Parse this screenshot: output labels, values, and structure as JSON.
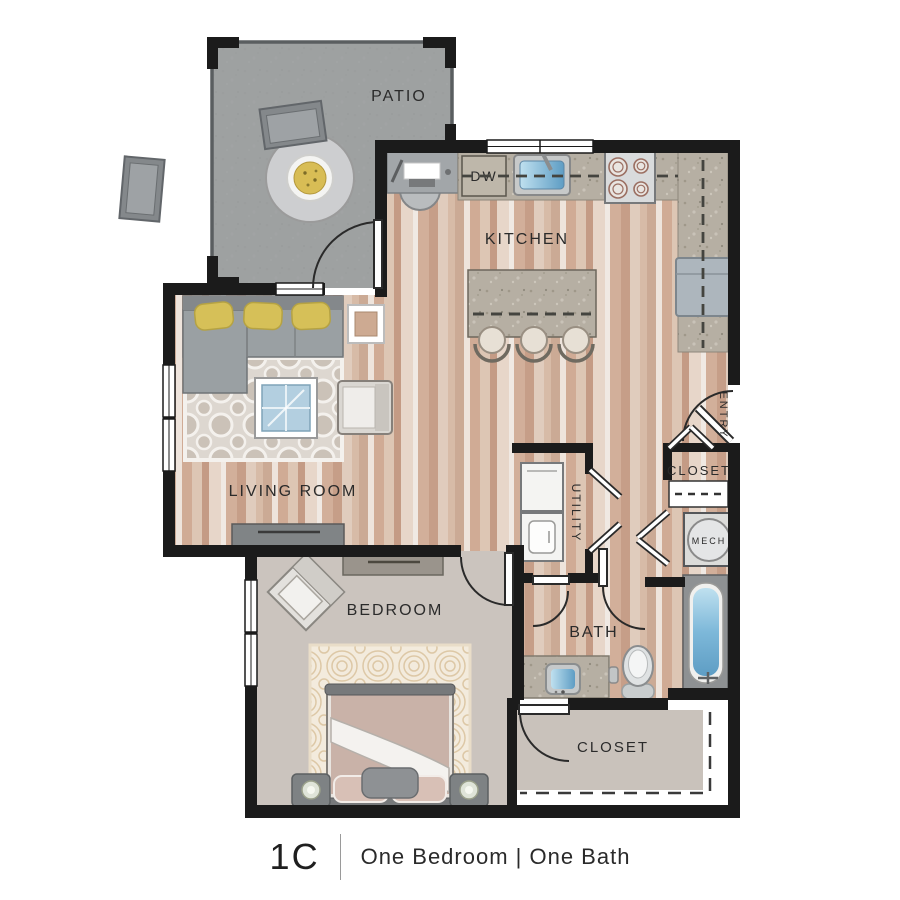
{
  "floorplan": {
    "patio_label": "PATIO",
    "kitchen_label": "KITCHEN",
    "living_room_label": "LIVING ROOM",
    "bedroom_label": "BEDROOM",
    "bath_label": "BATH",
    "utility_label": "UTILITY",
    "entry_label": "ENTRY",
    "entry_closet_label": "CLOSET",
    "mech_label": "MECH",
    "walkin_closet_label": "CLOSET",
    "dishwasher_label": "DW",
    "colors": {
      "wall": "#1b1b1b",
      "wood_floor": "#d3b6a1",
      "carpet": "#cbc4be",
      "patio_concrete": "#9b9fa1",
      "counter_granite": "#b4ada0",
      "water_blue": "#7db8d9",
      "pillow_yellow": "#d5bf55"
    }
  },
  "caption": {
    "plan_code": "1C",
    "description": "One Bedroom | One Bath"
  }
}
